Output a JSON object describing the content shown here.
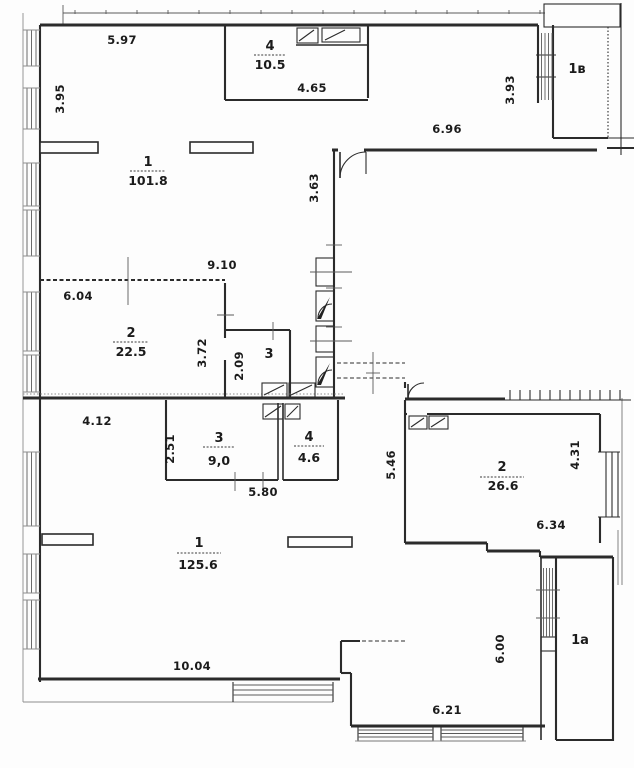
{
  "rooms": {
    "top_room1": {
      "number": "1",
      "area": "101.8"
    },
    "top_room2": {
      "number": "2",
      "area": "22.5"
    },
    "top_room3": {
      "number": "3"
    },
    "top_room4": {
      "number": "4",
      "area": "10.5"
    },
    "top_room_1v": {
      "label": "1в"
    },
    "bot_room1": {
      "number": "1",
      "area": "125.6"
    },
    "bot_room2": {
      "number": "2",
      "area": "26.6"
    },
    "bot_room3": {
      "number": "3",
      "area": "9,0"
    },
    "bot_room4": {
      "number": "4",
      "area": "4.6"
    },
    "bot_room_1a": {
      "label": "1a"
    }
  },
  "dimensions": {
    "d5_97": "5.97",
    "d3_95": "3.95",
    "d4_65": "4.65",
    "d3_93": "3.93",
    "d6_96": "6.96",
    "d3_63": "3.63",
    "d9_10": "9.10",
    "d6_04": "6.04",
    "d3_72": "3.72",
    "d2_09": "2.09",
    "d4_12": "4.12",
    "d2_51": "2.51",
    "d5_80": "5.80",
    "d5_46": "5.46",
    "d4_31": "4.31",
    "d6_34": "6.34",
    "d10_04": "10.04",
    "d6_00": "6.00",
    "d6_21": "6.21"
  },
  "line_colors": {
    "walls": "#2b2b2b",
    "thin": "#5a5a5a",
    "background": "#fdfdfd"
  }
}
